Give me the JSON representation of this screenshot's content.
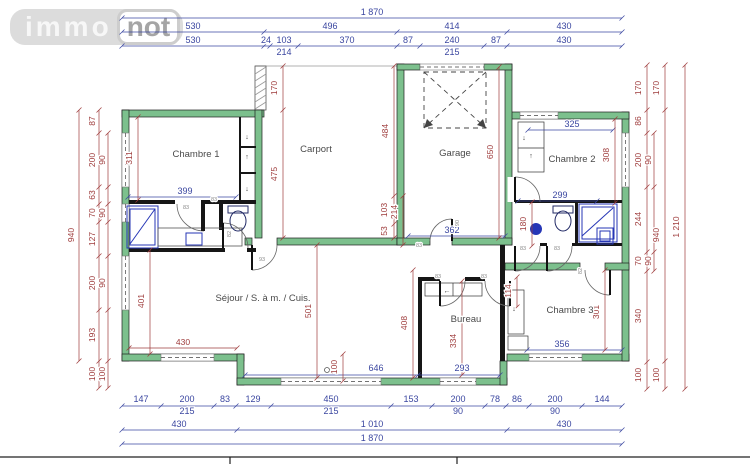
{
  "logo": {
    "immo": "immo",
    "not": "not"
  },
  "glyphs": {
    "up": "↑",
    "down": "↓",
    "left": "←"
  },
  "rooms": {
    "c1": "Chambre 1",
    "carport": "Carport",
    "garage": "Garage",
    "c2": "Chambre 2",
    "sejour": "Séjour / S. à m. / Cuis.",
    "bureau": "Bureau",
    "c3": "Chambre 3"
  },
  "dims": {
    "top": {
      "overall": "1 870",
      "row2": [
        "530",
        "496",
        "414",
        "430"
      ],
      "row3": [
        "530",
        "24",
        "103",
        "370",
        "87",
        "240",
        "87",
        "430"
      ],
      "row4": [
        "214",
        "215"
      ]
    },
    "bottom": {
      "row1": [
        "147",
        "200",
        "83",
        "129",
        "450",
        "153",
        "200",
        "78",
        "86",
        "200",
        "144"
      ],
      "row1_sub": [
        "215",
        "215",
        "90",
        "90"
      ],
      "row2": [
        "430",
        "1 010",
        "430"
      ],
      "row3": "1 870"
    },
    "left": {
      "chain": [
        "87",
        "200",
        "63",
        "70",
        "127",
        "200",
        "193",
        "100"
      ],
      "sub": [
        "90",
        "90",
        "90",
        "100"
      ],
      "overall": "940"
    },
    "right": {
      "chain": [
        "170",
        "86",
        "200",
        "244",
        "70",
        "340",
        "100"
      ],
      "sub": [
        "90",
        "90"
      ],
      "mid": [
        "170",
        "940",
        "100"
      ],
      "overall": "1 210"
    },
    "interior": {
      "c1_h": "311",
      "c1_w": "399",
      "carport_top": "170",
      "carport_left": "475",
      "carport_right": "484",
      "cp1": "103",
      "cp2": "214",
      "cp3": "53",
      "garage_h": "650",
      "garage_w": "362",
      "c2_w": "325",
      "c2_h": "308",
      "bath2_w": "299",
      "bath2_h": "180",
      "sej_left": "401",
      "sej_mid": "501",
      "sej_right": "408",
      "sej_w": "430",
      "sej_win": "646",
      "step": "100",
      "bureau_h": "334",
      "bureau_w": "293",
      "hall": "114",
      "c3_w": "356",
      "c3_h": "301"
    }
  },
  "doors": [
    "83",
    "83",
    "82",
    "93",
    "83",
    "90",
    "83",
    "83",
    "83",
    "83",
    "82"
  ]
}
